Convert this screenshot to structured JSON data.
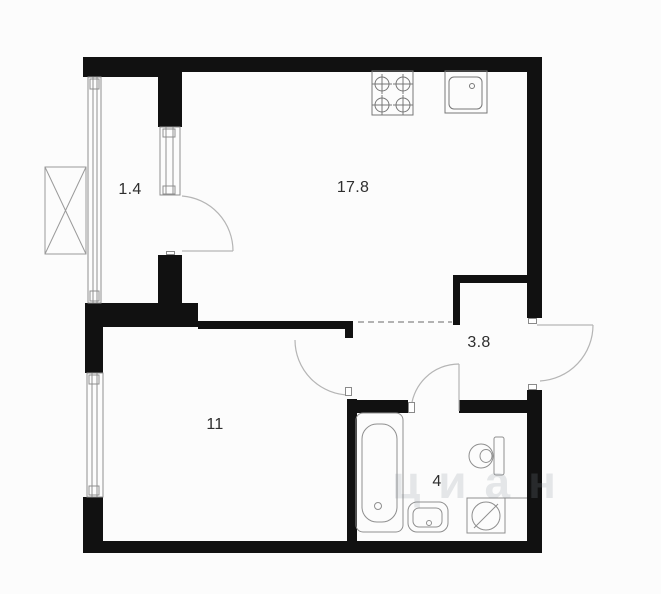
{
  "plan": {
    "title": "apartment-floor-plan",
    "colors": {
      "background": "#fcfcfc",
      "wall": "#111111",
      "fixture_line": "#8f8f8f",
      "door_arc": "#b5b5b5",
      "label_text": "#2e2e2e"
    },
    "rooms": [
      {
        "id": "balcony",
        "area_label": "1.4"
      },
      {
        "id": "kitchen-living",
        "area_label": "17.8"
      },
      {
        "id": "hallway",
        "area_label": "3.8"
      },
      {
        "id": "bedroom",
        "area_label": "11"
      },
      {
        "id": "bathroom",
        "area_label": "4"
      }
    ],
    "fixtures": [
      "stove-icon",
      "kitchen-sink-icon",
      "bathtub-icon",
      "toilet-icon",
      "bathroom-sink-icon",
      "washing-machine-icon",
      "air-conditioner-icon"
    ],
    "doors": [
      "balcony-door",
      "bedroom-door",
      "bathroom-door",
      "entrance-door"
    ],
    "windows": [
      "balcony-glazing",
      "balcony-window",
      "bedroom-window"
    ],
    "watermark": "циан"
  }
}
